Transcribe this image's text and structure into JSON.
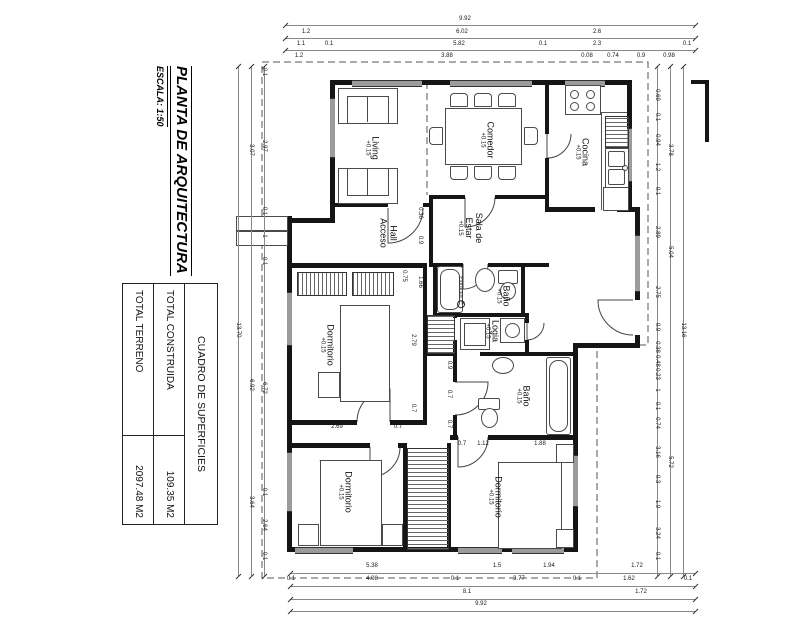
{
  "sheet": {
    "title": "PLANTA DE ARQUITECTURA",
    "scale": "ESCALA: 1:50"
  },
  "areas_table": {
    "header": "CUADRO DE SUPERFICIES",
    "rows": [
      {
        "label": "TOTAL CONSTRUIDA",
        "value": "109.35 M2"
      },
      {
        "label": "TOTAL TERRENO",
        "value": "2097.48 M2"
      }
    ]
  },
  "rooms": {
    "living": {
      "name": "Living",
      "level": "+0.15"
    },
    "comedor": {
      "name": "Comedor",
      "level": "+0.15"
    },
    "cocina": {
      "name": "Cocina",
      "level": "+0.15"
    },
    "hall": {
      "line1": "Hall",
      "line2": "Acceso"
    },
    "sala": {
      "line1": "Sala de",
      "line2": "Estar",
      "level": "+0.15"
    },
    "bano1": {
      "name": "Baño",
      "level": "+0.15",
      "extractor": "Extractor"
    },
    "dormitorio1": {
      "name": "Dormitorio",
      "level": "+0.15"
    },
    "logia": {
      "name": "Logia",
      "level": "+0.15"
    },
    "bano2": {
      "name": "Baño",
      "level": "+0.15"
    },
    "dormitorio2": {
      "name": "Dormitorio",
      "level": "+0.15"
    },
    "dormitorio3": {
      "name": "Dormitorio",
      "level": "+0.15"
    }
  },
  "dimensions": {
    "lines": [
      {
        "x1": 285,
        "y1": 25,
        "x2": 695,
        "y2": 25
      },
      {
        "x1": 285,
        "y1": 38,
        "x2": 695,
        "y2": 38
      },
      {
        "x1": 285,
        "y1": 50,
        "x2": 695,
        "y2": 50
      },
      {
        "x1": 290,
        "y1": 573,
        "x2": 695,
        "y2": 573
      },
      {
        "x1": 290,
        "y1": 586,
        "x2": 695,
        "y2": 586
      },
      {
        "x1": 290,
        "y1": 599,
        "x2": 695,
        "y2": 599
      },
      {
        "x1": 290,
        "y1": 611,
        "x2": 695,
        "y2": 611
      },
      {
        "x1": 238,
        "y1": 66,
        "x2": 238,
        "y2": 576
      },
      {
        "x1": 251,
        "y1": 66,
        "x2": 251,
        "y2": 576
      },
      {
        "x1": 264,
        "y1": 66,
        "x2": 264,
        "y2": 576
      },
      {
        "x1": 657,
        "y1": 66,
        "x2": 657,
        "y2": 576
      },
      {
        "x1": 670,
        "y1": 66,
        "x2": 670,
        "y2": 576
      },
      {
        "x1": 683,
        "y1": 66,
        "x2": 683,
        "y2": 576
      }
    ],
    "labels": [
      {
        "t": "9.92",
        "x": 465,
        "y": 19
      },
      {
        "t": "1.2",
        "x": 306,
        "y": 32
      },
      {
        "t": "6.02",
        "x": 462,
        "y": 32
      },
      {
        "t": "2.6",
        "x": 597,
        "y": 32
      },
      {
        "t": "1.1",
        "x": 301,
        "y": 44
      },
      {
        "t": "0.1",
        "x": 329,
        "y": 44
      },
      {
        "t": "5.82",
        "x": 459,
        "y": 44
      },
      {
        "t": "0.1",
        "x": 543,
        "y": 44
      },
      {
        "t": "2.3",
        "x": 597,
        "y": 44
      },
      {
        "t": "0.1",
        "x": 687,
        "y": 44
      },
      {
        "t": "1.2",
        "x": 299,
        "y": 56
      },
      {
        "t": "3.88",
        "x": 447,
        "y": 56
      },
      {
        "t": "0.08",
        "x": 587,
        "y": 56
      },
      {
        "t": "0.74",
        "x": 613,
        "y": 56
      },
      {
        "t": "0.9",
        "x": 641,
        "y": 56
      },
      {
        "t": "0.98",
        "x": 669,
        "y": 56
      },
      {
        "t": "5.38",
        "x": 372,
        "y": 566
      },
      {
        "t": "1.5",
        "x": 497,
        "y": 566
      },
      {
        "t": "1.94",
        "x": 549,
        "y": 566
      },
      {
        "t": "1.72",
        "x": 637,
        "y": 566
      },
      {
        "t": "0.1",
        "x": 291,
        "y": 579
      },
      {
        "t": "4.08",
        "x": 372,
        "y": 579
      },
      {
        "t": "0.1",
        "x": 455,
        "y": 579
      },
      {
        "t": "3.77",
        "x": 519,
        "y": 579
      },
      {
        "t": "0.1",
        "x": 577,
        "y": 579
      },
      {
        "t": "1.62",
        "x": 629,
        "y": 579
      },
      {
        "t": "0.1",
        "x": 688,
        "y": 579
      },
      {
        "t": "8.1",
        "x": 467,
        "y": 592
      },
      {
        "t": "1.72",
        "x": 641,
        "y": 592
      },
      {
        "t": "9.92",
        "x": 481,
        "y": 604
      },
      {
        "t": "13.70",
        "x": 238,
        "y": 330,
        "v": 1
      },
      {
        "t": "3.07",
        "x": 251,
        "y": 150,
        "v": 1
      },
      {
        "t": "6.92",
        "x": 251,
        "y": 385,
        "v": 1
      },
      {
        "t": "3.64",
        "x": 251,
        "y": 502,
        "v": 1
      },
      {
        "t": "0.1",
        "x": 264,
        "y": 72,
        "v": 1
      },
      {
        "t": "2.97",
        "x": 264,
        "y": 146,
        "v": 1
      },
      {
        "t": "0.1",
        "x": 264,
        "y": 211,
        "v": 1
      },
      {
        "t": "1",
        "x": 264,
        "y": 236,
        "v": 1
      },
      {
        "t": "0.1",
        "x": 264,
        "y": 261,
        "v": 1
      },
      {
        "t": "6.72",
        "x": 264,
        "y": 388,
        "v": 1
      },
      {
        "t": "0.1",
        "x": 264,
        "y": 492,
        "v": 1
      },
      {
        "t": "2.64",
        "x": 264,
        "y": 525,
        "v": 1
      },
      {
        "t": "0.1",
        "x": 264,
        "y": 556,
        "v": 1
      },
      {
        "t": "13.16",
        "x": 683,
        "y": 330,
        "v": 1
      },
      {
        "t": "3.78",
        "x": 670,
        "y": 150,
        "v": 1
      },
      {
        "t": "5.04",
        "x": 670,
        "y": 252,
        "v": 1
      },
      {
        "t": "5.72",
        "x": 670,
        "y": 462,
        "v": 1
      },
      {
        "t": "0.69",
        "x": 657,
        "y": 95,
        "v": 1
      },
      {
        "t": "0.1",
        "x": 657,
        "y": 117,
        "v": 1
      },
      {
        "t": "0.94",
        "x": 657,
        "y": 140,
        "v": 1
      },
      {
        "t": "1.2",
        "x": 657,
        "y": 167,
        "v": 1
      },
      {
        "t": "0.1",
        "x": 657,
        "y": 191,
        "v": 1
      },
      {
        "t": "2.89",
        "x": 657,
        "y": 232,
        "v": 1
      },
      {
        "t": "2.75",
        "x": 657,
        "y": 292,
        "v": 1
      },
      {
        "t": "0.9",
        "x": 657,
        "y": 327,
        "v": 1
      },
      {
        "t": "0.38",
        "x": 657,
        "y": 347,
        "v": 1
      },
      {
        "t": "0.48",
        "x": 657,
        "y": 361,
        "v": 1
      },
      {
        "t": "0.23",
        "x": 657,
        "y": 374,
        "v": 1
      },
      {
        "t": "1",
        "x": 657,
        "y": 390,
        "v": 1
      },
      {
        "t": "0.1",
        "x": 657,
        "y": 406,
        "v": 1
      },
      {
        "t": "0.74",
        "x": 657,
        "y": 423,
        "v": 1
      },
      {
        "t": "3.16",
        "x": 657,
        "y": 452,
        "v": 1
      },
      {
        "t": "0.3",
        "x": 657,
        "y": 479,
        "v": 1
      },
      {
        "t": "1.9",
        "x": 657,
        "y": 504,
        "v": 1
      },
      {
        "t": "3.24",
        "x": 657,
        "y": 533,
        "v": 1
      },
      {
        "t": "0.1",
        "x": 657,
        "y": 556,
        "v": 1
      },
      {
        "t": "0.36",
        "x": 420,
        "y": 213,
        "v": 1
      },
      {
        "t": "0.9",
        "x": 420,
        "y": 240,
        "v": 1
      },
      {
        "t": "1.66",
        "x": 420,
        "y": 282,
        "v": 1
      },
      {
        "t": "0.75",
        "x": 404,
        "y": 276,
        "v": 1
      },
      {
        "t": "2.79",
        "x": 413,
        "y": 340,
        "v": 1
      },
      {
        "t": "0.7",
        "x": 413,
        "y": 408,
        "v": 1
      },
      {
        "t": "0.9",
        "x": 449,
        "y": 365,
        "v": 1
      },
      {
        "t": "0.7",
        "x": 449,
        "y": 394,
        "v": 1
      },
      {
        "t": "0.7",
        "x": 449,
        "y": 424,
        "v": 1
      },
      {
        "t": "2.69",
        "x": 337,
        "y": 427
      },
      {
        "t": "0.7",
        "x": 398,
        "y": 427
      },
      {
        "t": "0.7",
        "x": 462,
        "y": 444
      },
      {
        "t": "1.12",
        "x": 483,
        "y": 444
      },
      {
        "t": "1.88",
        "x": 540,
        "y": 444
      }
    ]
  }
}
